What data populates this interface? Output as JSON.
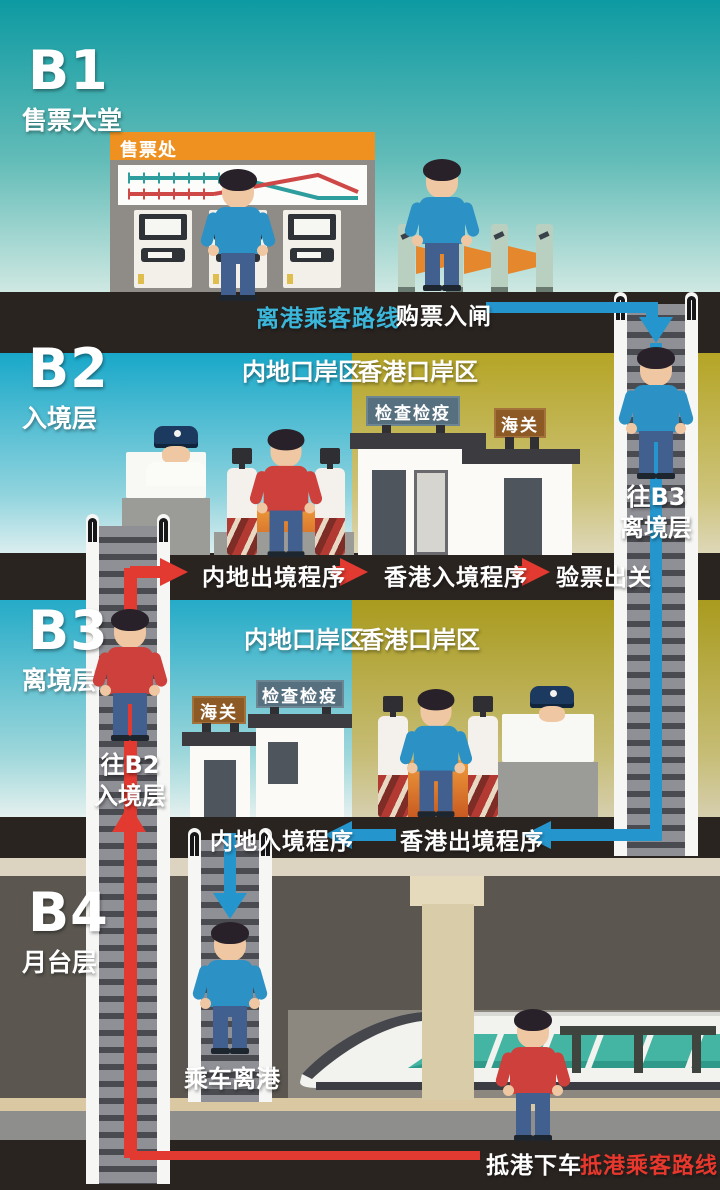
{
  "legend": {
    "depart_route": "离港乘客路线",
    "arrive_route": "抵港乘客路线"
  },
  "floors": {
    "b1": {
      "code": "B1",
      "name": "售票大堂"
    },
    "b2": {
      "code": "B2",
      "name": "入境层"
    },
    "b3": {
      "code": "B3",
      "name": "离境层"
    },
    "b4": {
      "code": "B4",
      "name": "月台层"
    }
  },
  "zones": {
    "mainland": "内地口岸区",
    "hongkong": "香港口岸区"
  },
  "signs": {
    "ticket_office": "售票处",
    "inspection": "检查检疫",
    "customs": "海关"
  },
  "steps": {
    "buy_ticket": "购票入闸",
    "mainland_exit": "内地出境程序",
    "hk_entry": "香港入境程序",
    "ticket_check_exit": "验票出关",
    "mainland_entry": "内地入境程序",
    "hk_exit": "香港出境程序",
    "board_train": "乘车离港",
    "alight": "抵港下车",
    "to_b3_line1": "往B3",
    "to_b3_line2": "离境层",
    "to_b2_line1": "往B2",
    "to_b2_line2": "入境层"
  },
  "colors": {
    "depart_blue": "#2596cd",
    "arrive_red": "#e23a30",
    "mainland_cyan": "#16a7c9",
    "hongkong_olive": "#b0a124",
    "band_dark": "#2a2421",
    "ticket_header_orange": "#ee9121"
  }
}
